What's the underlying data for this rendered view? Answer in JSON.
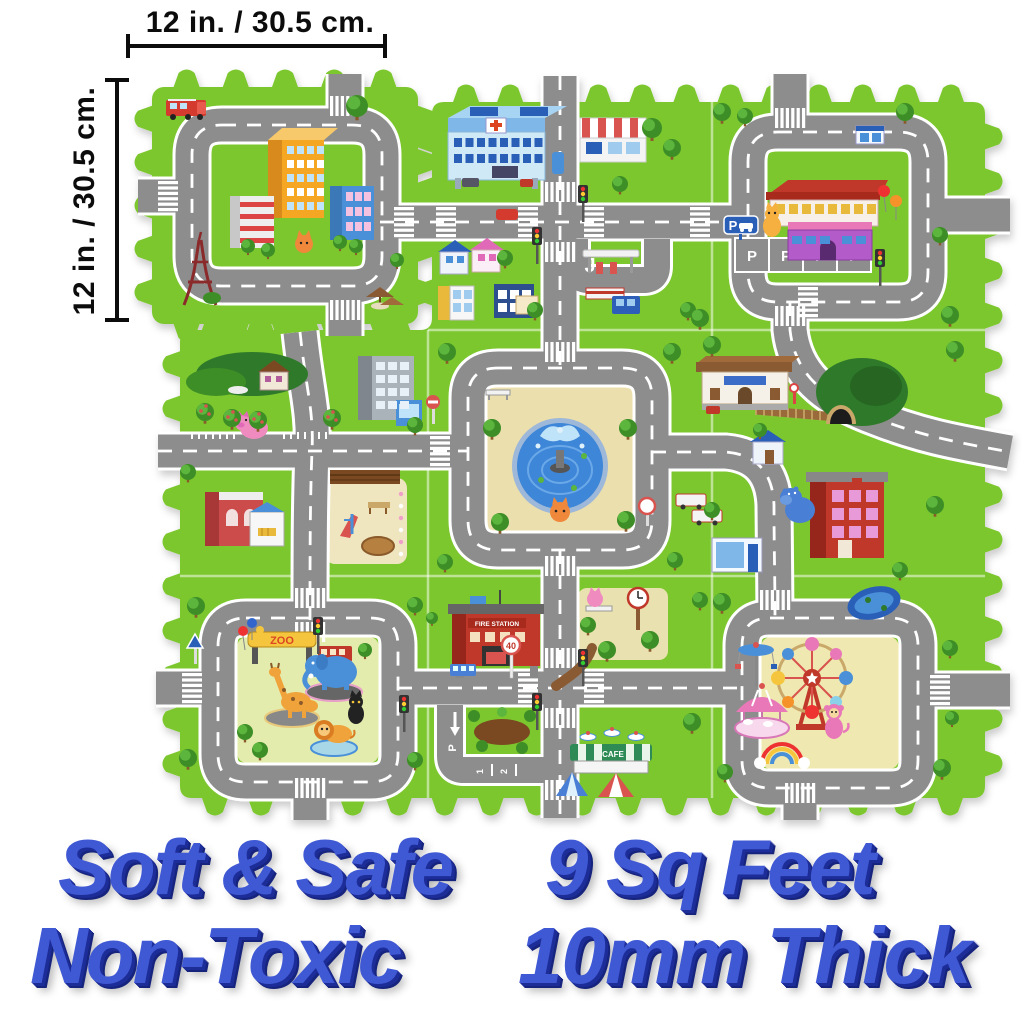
{
  "product_annotations": {
    "top_dimension_label": "12 in. / 30.5 cm.",
    "left_dimension_label": "12 in. / 30.5 cm."
  },
  "marketing_text": {
    "top_left": "Soft & Safe",
    "bottom_left": "Non-Toxic",
    "top_right": "9 Sq Feet",
    "bottom_right": "10mm Thick"
  },
  "mat_labels": {
    "zoo_sign": "ZOO",
    "fire_station_sign": "FIRE STATION",
    "cafe_sign": "CAFE",
    "speed_limit_sign": "40",
    "parking_sign": "P",
    "parking_stall_letter": "P",
    "lane_numbers": [
      "1",
      "2"
    ],
    "turn_marking": "J"
  },
  "colors": {
    "grass": "#7cc72f",
    "grass_shade": "#6ab526",
    "road": "#8d8d8d",
    "road_marking": "#ffffff",
    "water": "#3e86d8",
    "interior_tan": "#ecdfae",
    "interior_pale": "#e3ecad",
    "marketing_blue": "#3f58d4",
    "marketing_blue_shadow": "#1d2d98",
    "annotation_black": "#0c0c0c",
    "foam_background": "#ffffff"
  },
  "scene": {
    "description": "9-piece interlocking foam puzzle play mat printed with a city road map",
    "tiles": [
      {
        "id": "city-block-detached",
        "landmarks": [
          "apartment-buildings-icon",
          "eiffel-tower-icon",
          "fire-truck-icon",
          "umbrella-tables-icon"
        ]
      },
      {
        "id": "hospital",
        "landmarks": [
          "hospital-icon",
          "striped-market-icon",
          "houses-icon",
          "gas-station-icon"
        ]
      },
      {
        "id": "shopping-mall-parking",
        "landmarks": [
          "mall-icon",
          "parking-spaces-icon",
          "balloons-icon",
          "cat-icon",
          "traffic-light-icon"
        ]
      },
      {
        "id": "orchard-playground",
        "landmarks": [
          "apple-trees-icon",
          "pig-icon",
          "hill-house-icon",
          "office-building-icon",
          "playground-icon"
        ]
      },
      {
        "id": "fountain-plaza",
        "landmarks": [
          "fountain-icon",
          "bench-icon",
          "cat-icon",
          "no-entry-sign-icon"
        ]
      },
      {
        "id": "train-station",
        "landmarks": [
          "station-icon",
          "railway-icon",
          "tunnel-icon",
          "school-icon",
          "hippo-icon",
          "trucks-icon"
        ]
      },
      {
        "id": "zoo",
        "landmarks": [
          "zoo-arch-icon",
          "balloons-icon",
          "elephant-icon",
          "giraffe-icon",
          "lion-icon",
          "black-cat-icon",
          "bus-icon"
        ]
      },
      {
        "id": "fire-station-cafe",
        "landmarks": [
          "fire-station-icon",
          "clock-tower-icon",
          "cafe-awning-icon",
          "tents-icon",
          "parking-lanes-icon",
          "dirt-path-icon"
        ]
      },
      {
        "id": "amusement-park",
        "landmarks": [
          "ferris-wheel-icon",
          "carousel-icon",
          "swing-ride-icon",
          "rainbow-arch-icon",
          "monkey-icon",
          "pond-icon"
        ]
      }
    ]
  }
}
